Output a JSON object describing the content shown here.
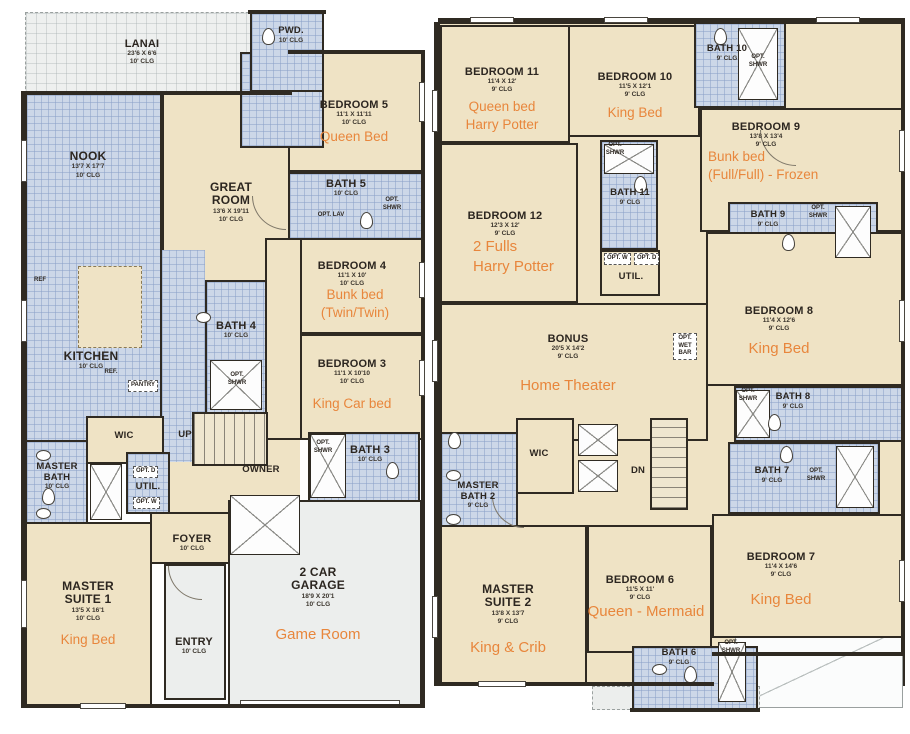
{
  "colors": {
    "wall": "#2f2a22",
    "room_fill": "#efe3c5",
    "wet_fill": "#ccd7e8",
    "garage_fill": "#eceeed",
    "accent_orange": "#e8863c"
  },
  "rooms": {
    "lanai": {
      "name": "LANAI",
      "dims": "23'6 X 6'6",
      "clg": "10' CLG"
    },
    "nook": {
      "name": "NOOK",
      "dims": "13'7 X 17'7",
      "clg": "10' CLG"
    },
    "great_room": {
      "name": "GREAT ROOM",
      "dims": "13'6 X 19'11",
      "clg": "10' CLG"
    },
    "pwd": {
      "name": "PWD.",
      "clg": "10' CLG"
    },
    "bedroom5": {
      "name": "BEDROOM 5",
      "dims": "11'1 X 11'11",
      "clg": "10' CLG",
      "note": [
        "Queen Bed"
      ]
    },
    "bath5": {
      "name": "BATH 5",
      "clg": "10' CLG"
    },
    "bedroom4": {
      "name": "BEDROOM 4",
      "dims": "11'1 X 10'",
      "clg": "10' CLG",
      "note": [
        "Bunk bed",
        "(Twin/Twin)"
      ]
    },
    "bath4": {
      "name": "BATH 4",
      "clg": "10' CLG"
    },
    "bedroom3": {
      "name": "BEDROOM 3",
      "dims": "11'1 X 10'10",
      "clg": "10' CLG",
      "note": [
        "King Car bed"
      ]
    },
    "bath3": {
      "name": "BATH 3",
      "clg": "10' CLG"
    },
    "kitchen": {
      "name": "KITCHEN",
      "clg": "10' CLG"
    },
    "wic": {
      "name": "WIC"
    },
    "up": {
      "name": "UP"
    },
    "owner": {
      "name": "OWNER"
    },
    "master_bath": {
      "name": "MASTER BATH",
      "clg": "10' CLG"
    },
    "util": {
      "name": "UTIL."
    },
    "foyer": {
      "name": "FOYER",
      "clg": "10' CLG"
    },
    "master_suite1": {
      "name": "MASTER SUITE 1",
      "dims": "13'5 X 16'1",
      "clg": "10' CLG",
      "note": [
        "King Bed"
      ]
    },
    "entry": {
      "name": "ENTRY",
      "clg": "10' CLG"
    },
    "garage": {
      "name": "2 CAR GARAGE",
      "dims": "18'9 X 20'1",
      "clg": "10' CLG",
      "note": [
        "Game Room"
      ]
    },
    "bedroom11": {
      "name": "BEDROOM 11",
      "dims": "11'4 X 12'",
      "clg": "9' CLG",
      "note": [
        "Queen bed",
        "Harry Potter"
      ]
    },
    "bedroom10": {
      "name": "BEDROOM 10",
      "dims": "11'5 X 12'1",
      "clg": "9' CLG",
      "note": [
        "King Bed"
      ]
    },
    "bath10": {
      "name": "BATH 10",
      "clg": "9' CLG"
    },
    "bedroom9": {
      "name": "BEDROOM 9",
      "dims": "13'8 X 13'4",
      "clg": "9' CLG",
      "note": [
        "Bunk bed",
        "(Full/Full) - Frozen"
      ]
    },
    "bath9": {
      "name": "BATH 9",
      "clg": "9' CLG"
    },
    "bedroom12": {
      "name": "BEDROOM 12",
      "dims": "12'3 X 12'",
      "clg": "9' CLG",
      "note": [
        "2 Fulls",
        "Harry Potter"
      ]
    },
    "bath11": {
      "name": "BATH 11",
      "clg": "9' CLG"
    },
    "util2": {
      "name": "UTIL."
    },
    "bonus": {
      "name": "BONUS",
      "dims": "20'5 X 14'2",
      "clg": "9' CLG",
      "note": [
        "Home Theater"
      ]
    },
    "bedroom8": {
      "name": "BEDROOM 8",
      "dims": "11'4 X 12'6",
      "clg": "9' CLG",
      "note": [
        "King Bed"
      ]
    },
    "bath8": {
      "name": "BATH 8",
      "clg": "9' CLG"
    },
    "bath7": {
      "name": "BATH 7",
      "clg": "9' CLG"
    },
    "bedroom7": {
      "name": "BEDROOM 7",
      "dims": "11'4 X 14'6",
      "clg": "9' CLG",
      "note": [
        "King Bed"
      ]
    },
    "dn": {
      "name": "DN"
    },
    "wic2": {
      "name": "WIC"
    },
    "master_bath2": {
      "name": "MASTER BATH 2",
      "clg": "9' CLG"
    },
    "master_suite2": {
      "name": "MASTER SUITE 2",
      "dims": "13'8 X 13'7",
      "clg": "9' CLG",
      "note": [
        "King & Crib"
      ]
    },
    "bedroom6": {
      "name": "BEDROOM 6",
      "dims": "11'5 X 11'",
      "clg": "9' CLG",
      "note": [
        "Queen - Mermaid"
      ]
    },
    "bath6": {
      "name": "BATH 6",
      "clg": "9' CLG"
    }
  },
  "labels": {
    "ref": "REF",
    "ref2": "REF.",
    "pantry": "PANTRY",
    "opt_shwr": "OPT. SHWR",
    "opt_lav": "OPT. LAV",
    "opt_w": "OPT. W",
    "opt_d": "OPT. D",
    "opt_wet_bar": "OPT. WET BAR"
  }
}
